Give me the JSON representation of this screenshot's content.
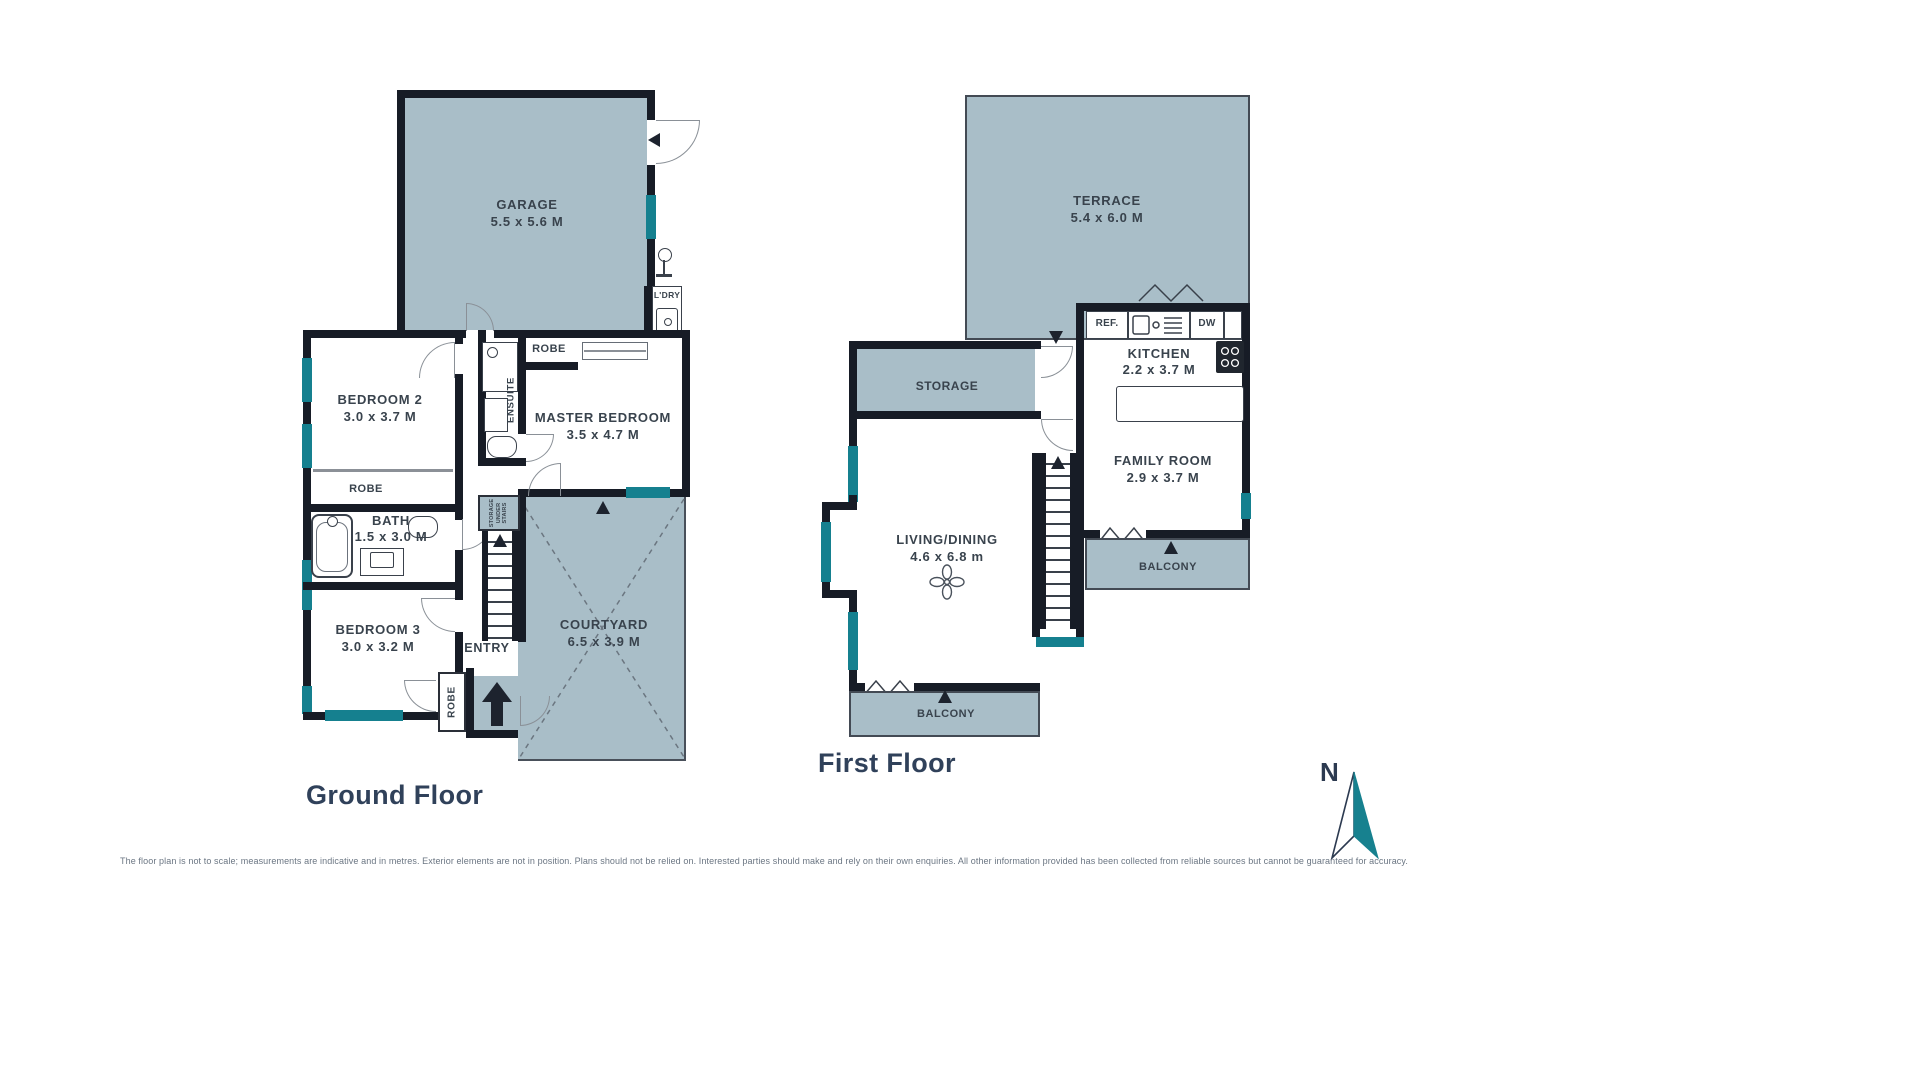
{
  "colors": {
    "room_fill": "#a9bec8",
    "wall": "#171c26",
    "window": "#15808f",
    "label_text": "#39434d",
    "title_text": "#30415a",
    "compass_teal": "#17818f",
    "footer_text": "#6b7683"
  },
  "ground_floor": {
    "title": "Ground Floor",
    "garage": {
      "name": "GARAGE",
      "dims": "5.5 x 5.6 M"
    },
    "laundry": {
      "name": "L'DRY"
    },
    "bedroom2": {
      "name": "BEDROOM 2",
      "dims": "3.0 x 3.7 M"
    },
    "robe_bedroom2": {
      "name": "ROBE"
    },
    "master_bedroom": {
      "name": "MASTER BEDROOM",
      "dims": "3.5 x 4.7 M"
    },
    "robe_master": {
      "name": "ROBE"
    },
    "ensuite": {
      "name": "ENSUITE"
    },
    "bath": {
      "name": "BATH",
      "dims": "1.5 x 3.0 M"
    },
    "bedroom3": {
      "name": "BEDROOM 3",
      "dims": "3.0 x 3.2 M"
    },
    "robe_bedroom3": {
      "name": "ROBE"
    },
    "entry": {
      "name": "ENTRY"
    },
    "storage_under_stairs": {
      "name": "STORAGE UNDER STAIRS"
    },
    "courtyard": {
      "name": "COURTYARD",
      "dims": "6.5 x 3.9 M"
    }
  },
  "first_floor": {
    "title": "First Floor",
    "terrace": {
      "name": "TERRACE",
      "dims": "5.4 x 6.0 M"
    },
    "storage": {
      "name": "STORAGE"
    },
    "kitchen": {
      "name": "KITCHEN",
      "dims": "2.2 x 3.7 M"
    },
    "fridge": {
      "name": "REF."
    },
    "dishwasher": {
      "name": "DW"
    },
    "family_room": {
      "name": "FAMILY ROOM",
      "dims": "2.9 x 3.7 M"
    },
    "living_dining": {
      "name": "LIVING/DINING",
      "dims": "4.6 x 6.8 m"
    },
    "balcony_living": {
      "name": "BALCONY"
    },
    "balcony_family": {
      "name": "BALCONY"
    }
  },
  "compass": {
    "north_label": "N"
  },
  "footer": {
    "disclaimer": "The floor plan is not to scale; measurements are indicative and in metres. Exterior elements are not in position. Plans should not be relied on. Interested parties should make and rely on their own enquiries. All other information provided has been collected from reliable sources but cannot be guaranteed for accuracy."
  }
}
